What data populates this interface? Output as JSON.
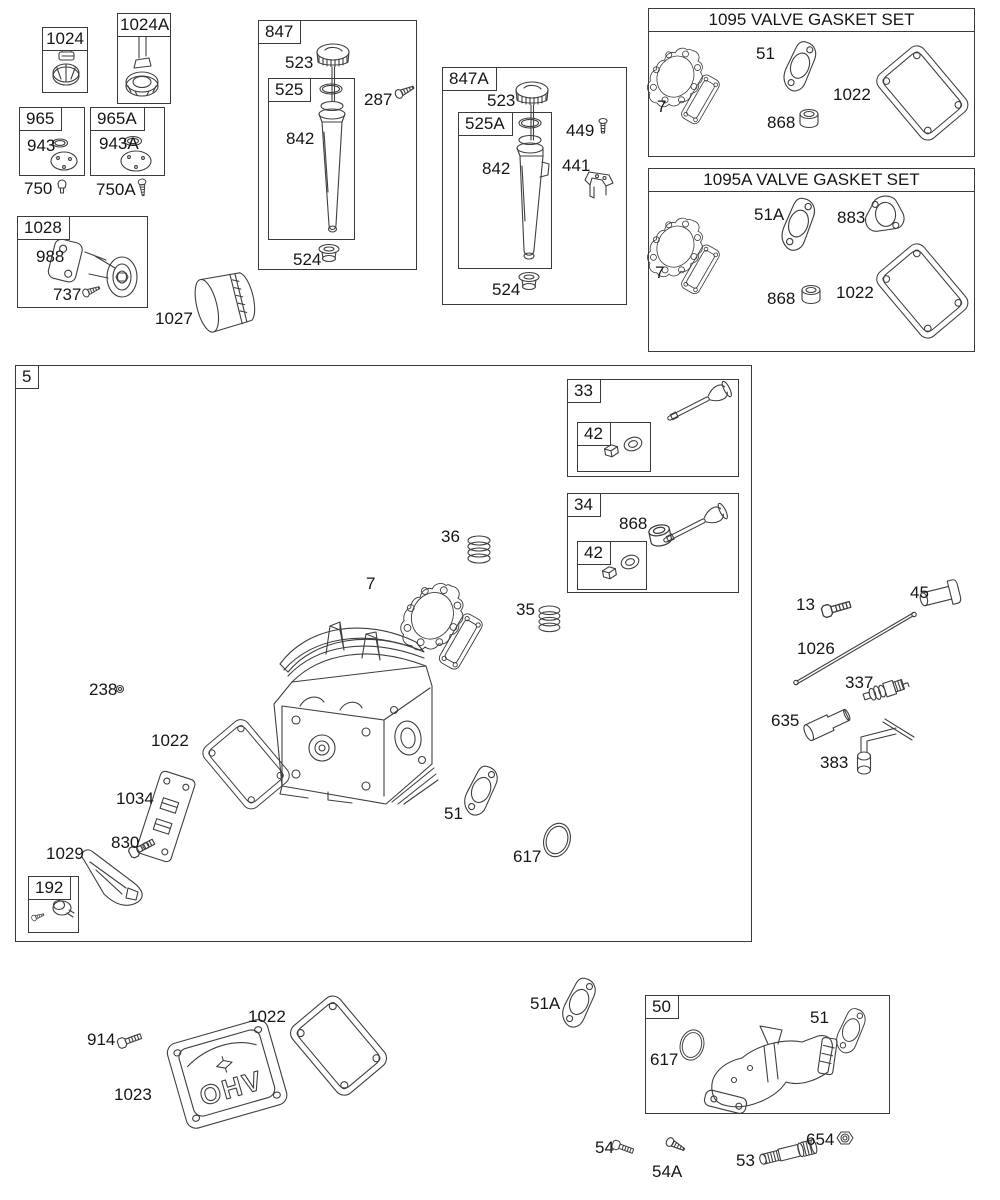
{
  "titles": {
    "set1095": "1095 VALVE GASKET SET",
    "set1095A": "1095A VALVE GASKET SET"
  },
  "parts": {
    "p5": "5",
    "p7": "7",
    "p13": "13",
    "p33": "33",
    "p34": "34",
    "p35": "35",
    "p36": "36",
    "p42": "42",
    "p45": "45",
    "p50": "50",
    "p51": "51",
    "p51A": "51A",
    "p53": "53",
    "p54": "54",
    "p54A": "54A",
    "p192": "192",
    "p238": "238",
    "p287": "287",
    "p337": "337",
    "p383": "383",
    "p441": "441",
    "p449": "449",
    "p523": "523",
    "p524": "524",
    "p525": "525",
    "p525A": "525A",
    "p617": "617",
    "p635": "635",
    "p654": "654",
    "p737": "737",
    "p750": "750",
    "p750A": "750A",
    "p830": "830",
    "p842": "842",
    "p847": "847",
    "p847A": "847A",
    "p868": "868",
    "p883": "883",
    "p914": "914",
    "p943": "943",
    "p943A": "943A",
    "p965": "965",
    "p965A": "965A",
    "p988": "988",
    "p1022": "1022",
    "p1023": "1023",
    "p1024": "1024",
    "p1024A": "1024A",
    "p1026": "1026",
    "p1027": "1027",
    "p1028": "1028",
    "p1029": "1029",
    "p1034": "1034",
    "cover_emboss": "OHV"
  }
}
